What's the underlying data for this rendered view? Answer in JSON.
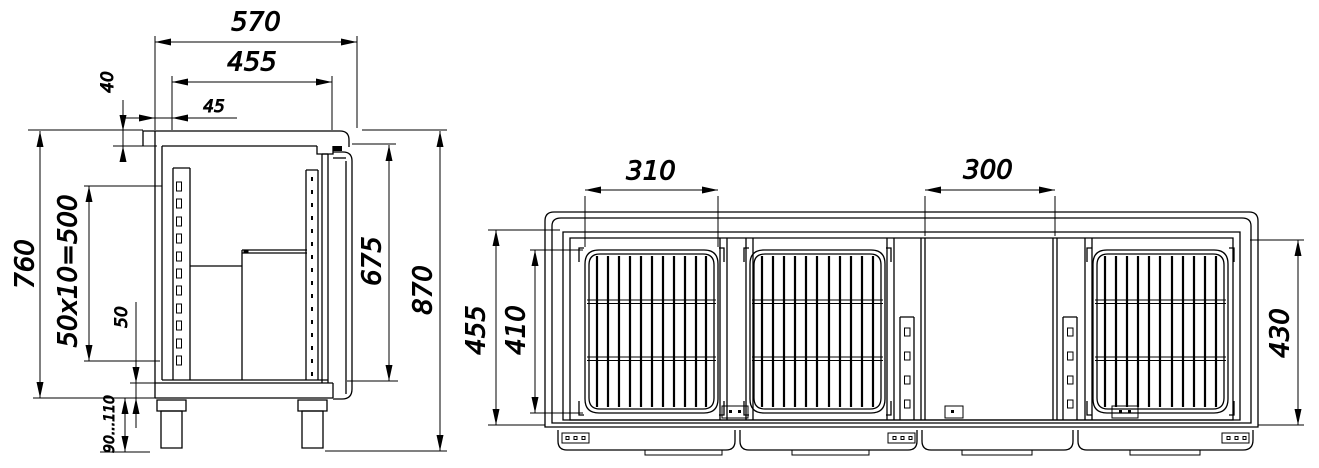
{
  "colors": {
    "ink": "#000000",
    "background": "#ffffff"
  },
  "side_view": {
    "dims": {
      "overall_depth": "570",
      "interior_depth": "455",
      "top_thickness": "40",
      "front_offset": "45",
      "case_height": "760",
      "rail_pitch": "50x10=500",
      "plinth_height": "50",
      "interior_height": "675",
      "overall_height": "870",
      "leg_range": "90...110"
    }
  },
  "front_view": {
    "dims": {
      "basket_width": "310",
      "opening_width": "300",
      "interior_height": "455",
      "basket_height": "410",
      "right_opening_height": "430"
    }
  }
}
